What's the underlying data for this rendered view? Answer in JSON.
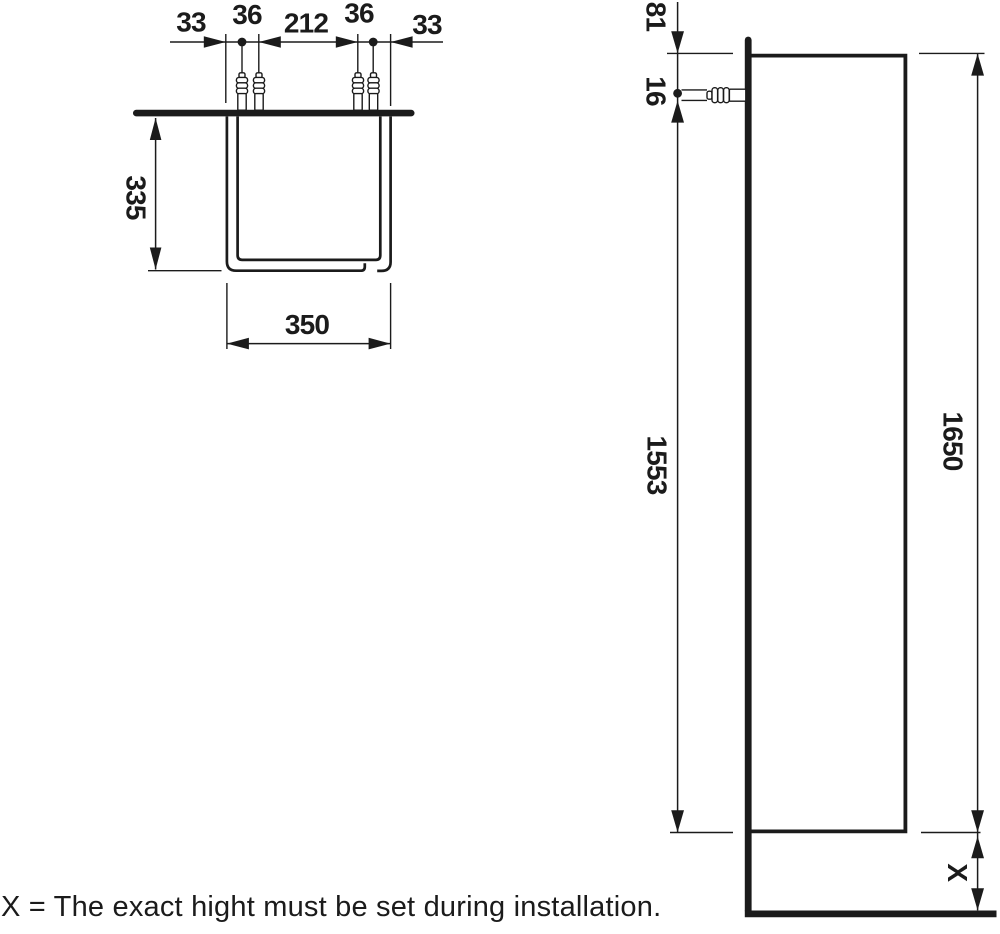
{
  "plan_view": {
    "chain_dims": [
      "33",
      "36",
      "212",
      "36",
      "33"
    ],
    "depth_dim": "335",
    "width_dim": "350"
  },
  "side_view": {
    "top_to_plug_dim": "81",
    "plug_dim": "16",
    "plug_to_bottom_dim": "1553",
    "cabinet_height_dim": "1650",
    "floor_clearance_dim": "X"
  },
  "footnote": "X = The exact hight must be set during installation.",
  "icons": [
    "wall-plug-icon"
  ],
  "colors": {
    "ink": "#1b1b1b",
    "background": "#ffffff"
  }
}
